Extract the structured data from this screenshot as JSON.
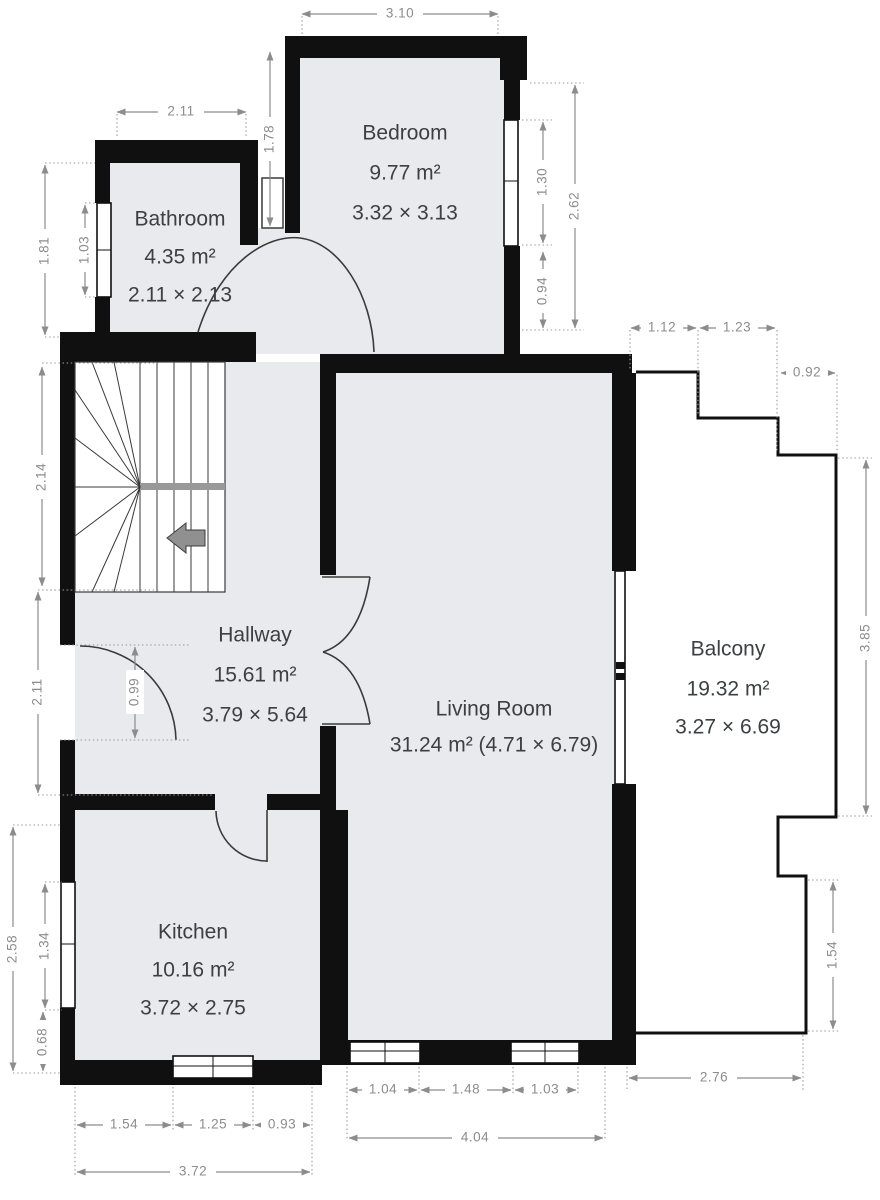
{
  "rooms": [
    {
      "id": "bathroom",
      "name": "Bathroom",
      "area": "4.35 m²",
      "size": "2.11 × 2.13"
    },
    {
      "id": "bedroom",
      "name": "Bedroom",
      "area": "9.77 m²",
      "size": "3.32 × 3.13"
    },
    {
      "id": "hallway",
      "name": "Hallway",
      "area": "15.61 m²",
      "size": "3.79 × 5.64"
    },
    {
      "id": "living_room",
      "name": "Living Room",
      "area_size": "31.24 m² (4.71 × 6.79)"
    },
    {
      "id": "balcony",
      "name": "Balcony",
      "area": "19.32 m²",
      "size": "3.27 × 6.69"
    },
    {
      "id": "kitchen",
      "name": "Kitchen",
      "area": "10.16 m²",
      "size": "3.72 × 2.75"
    }
  ],
  "dimensions": {
    "bedroom_top": "3.10",
    "bathroom_top": "2.11",
    "between_vert": "1.78",
    "bedroom_window": "1.30",
    "bedroom_right_total": "2.62",
    "bedroom_right_lower": "0.94",
    "balcony_step1": "1.12",
    "balcony_step2": "1.23",
    "balcony_step3": "0.92",
    "balcony_right": "3.85",
    "balcony_right_lower": "1.54",
    "balcony_bottom": "2.76",
    "living_window_left": "1.04",
    "living_between": "1.48",
    "living_window_right": "1.03",
    "living_bottom_total": "4.04",
    "kitchen_bottom_left": "1.54",
    "kitchen_bottom_window": "1.25",
    "kitchen_bottom_right": "0.93",
    "kitchen_bottom_total": "3.72",
    "kitchen_left_total": "2.58",
    "kitchen_left_window": "1.34",
    "kitchen_left_lower": "0.68",
    "hallway_left_total": "2.11",
    "hallway_left_door": "0.99",
    "stairs_left": "2.14",
    "bathroom_left_total": "1.81",
    "bathroom_left_window": "1.03"
  },
  "colors": {
    "wall": "#101010",
    "room_fill": "#e8eaed",
    "dimension": "#8c8c8c",
    "label": "#3c4043",
    "stairs_arrow": "#909090"
  },
  "icons": {
    "stairs_direction": "left-arrow"
  }
}
